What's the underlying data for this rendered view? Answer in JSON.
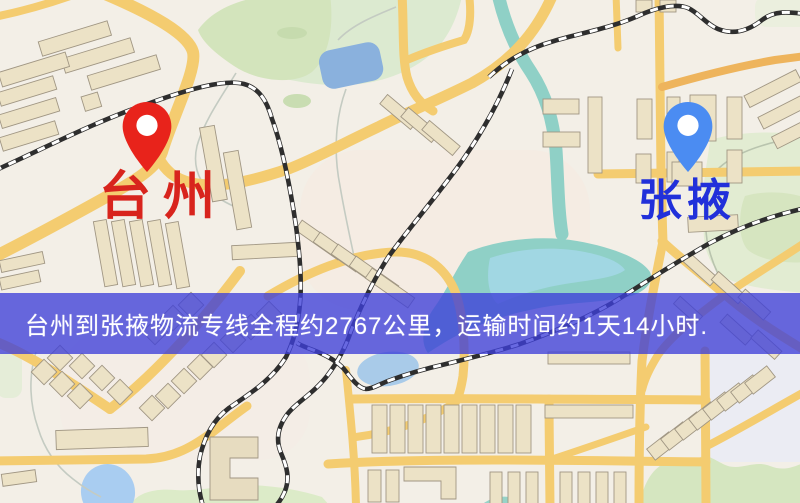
{
  "banner": {
    "text": "台州到张掖物流专线全程约2767公里，运输时间约1天14小时.",
    "background_color": "#3d3fd9",
    "text_color": "#ffffff"
  },
  "route": {
    "origin": "台州",
    "destination": "张掖",
    "distance": "约2767公里",
    "duration": "约1天14小时"
  },
  "markers": {
    "origin": {
      "label": "台州",
      "pin_color": "#e8231b",
      "label_color": "#d8241d"
    },
    "destination": {
      "label": "张掖",
      "pin_color": "#4b8cf2",
      "label_color": "#2130da"
    }
  },
  "map_colors": {
    "background": "#f3efe7",
    "road": "#f4cc70",
    "road_orange": "#eeb45c",
    "building": "#ece2c6",
    "park": "#d9e8c6",
    "water": "#a9cbe9",
    "river": "#8fd0c6",
    "railway_dark": "#2e2e2e"
  }
}
